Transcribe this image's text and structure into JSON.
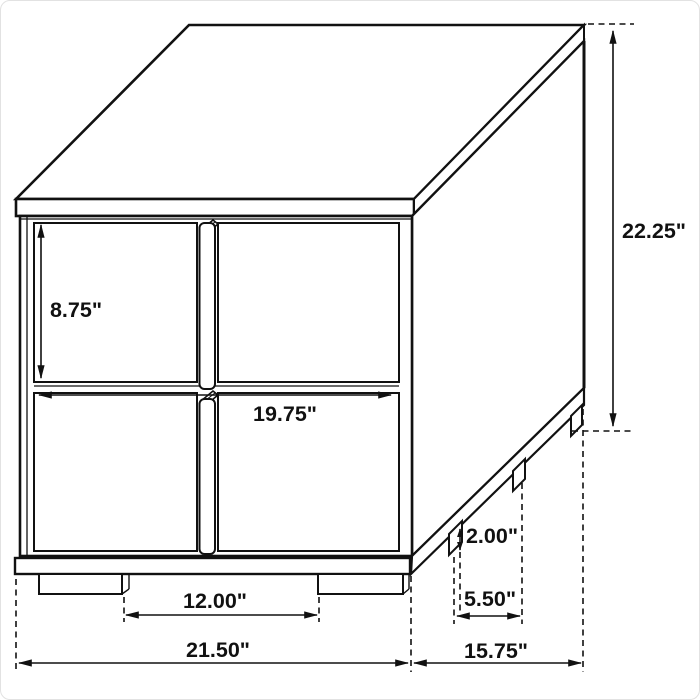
{
  "diagram": {
    "type": "furniture-dimension-drawing",
    "subject": "two-drawer nightstand line drawing, isometric view",
    "unit": "inches",
    "line_color": "#111111",
    "background_color": "#ffffff",
    "dimensions": {
      "overall_height": "22.25\"",
      "drawer_front_height": "8.75\"",
      "drawer_front_width": "19.75\"",
      "leg_height": "2.00\"",
      "side_leg_spacing": "5.50\"",
      "front_leg_spacing": "12.00\"",
      "overall_width": "21.50\"",
      "overall_depth": "15.75\""
    }
  }
}
